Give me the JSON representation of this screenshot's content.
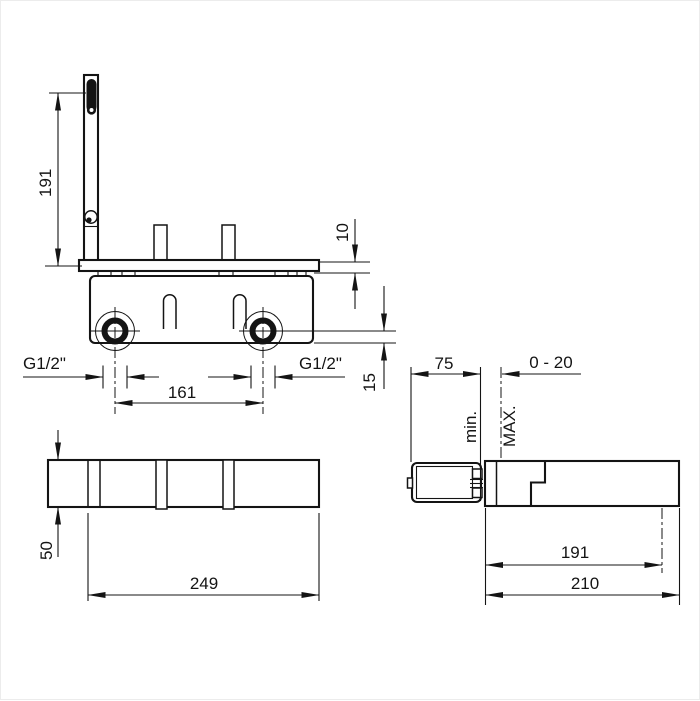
{
  "page": {
    "background": "#ffffff",
    "line_color": "#141414",
    "description": "Technical dimension drawing, concealed mixer valve body, three orthographic views"
  },
  "views": {
    "front": {
      "dims": {
        "bracket_height": "191",
        "plate_thickness": "10",
        "port_center_to_bottom": "15",
        "port_spacing": "161",
        "thread_left": "G1/2\"",
        "thread_right": "G1/2\""
      }
    },
    "bottom": {
      "dims": {
        "depth": "50",
        "length": "249"
      }
    },
    "side": {
      "dims": {
        "min_installation_depth": "75",
        "adjustment_range": "0 - 20",
        "label_min": "min.",
        "label_max": "MAX.",
        "inner_length": "191",
        "total_length": "210"
      }
    }
  }
}
